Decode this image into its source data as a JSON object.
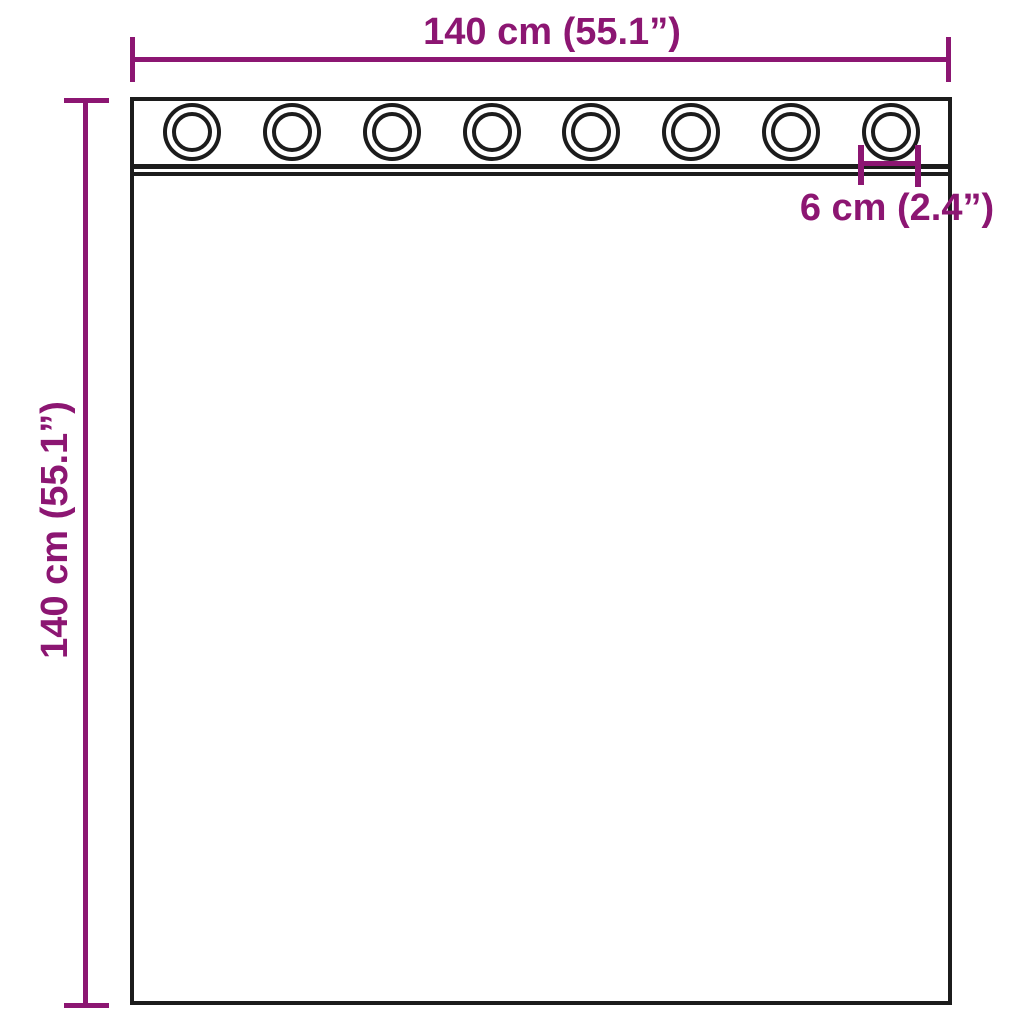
{
  "diagram": {
    "background_color": "#ffffff",
    "accent_color": "#8c1672",
    "outline_color": "#1c1c1c",
    "width_dimension": {
      "label": "140 cm (55.1”)"
    },
    "height_dimension": {
      "label": "140 cm (55.1”)"
    },
    "grommet_spacing_dimension": {
      "label": "6 cm (2.4”)"
    },
    "grommet_count": 8
  }
}
